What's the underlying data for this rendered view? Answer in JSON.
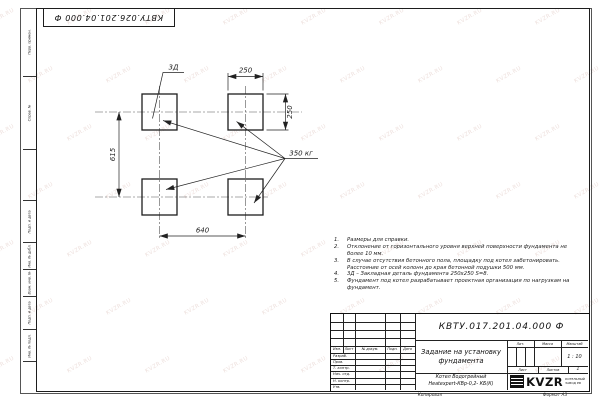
{
  "sheet": {
    "top_stamp": "КВТУ.026.201.04.000 Ф",
    "copied_label": "Копировал",
    "format_label": "Формат А3"
  },
  "watermark": {
    "text": "KVZR.RU"
  },
  "margin_boxes": [
    {
      "label": "Перв. примен."
    },
    {
      "label": "Справ. №"
    },
    {
      "label": "Подп. и дата"
    },
    {
      "label": "Инв. № дубл."
    },
    {
      "label": "Взам. инв. №"
    },
    {
      "label": "Подп. и дата"
    },
    {
      "label": "Инв. № подл."
    }
  ],
  "drawing": {
    "dim_top": "250",
    "dim_right": "250",
    "dim_left": "615",
    "dim_bottom": "640",
    "embed_label": "3Д",
    "weight_label": "350 кг"
  },
  "notes": [
    {
      "num": "1.",
      "text": "Размеры для справки."
    },
    {
      "num": "2.",
      "text": "Отклонение от горизонтального уровня верхней поверхности фундамента не более 10 мм."
    },
    {
      "num": "3.",
      "text": "В случае отсутствия бетонного пола, площадку под котел забетонировать. Расстояние от осей колонн до края бетонной подушки 500 мм."
    },
    {
      "num": "4.",
      "text": "3Д – Закладная деталь фундамента 250х250 S=8."
    },
    {
      "num": "5.",
      "text": "Фундамент под котел разрабатывает проектная организация по нагрузкам на фундамент."
    }
  ],
  "title_block": {
    "doc_number": "КВТУ.017.201.04.000 Ф",
    "title": "Задание на установку фундамента",
    "product_line1": "Котел Водогрейный",
    "product_line2": "Heatexpert-КВр-0,2- КБ(К)",
    "col_izm": "Изм.",
    "col_list": "Лист",
    "col_docnum": "№ докум.",
    "col_podp": "Подп.",
    "col_data": "Дата",
    "row_razrab": "Разраб.",
    "row_prov": "Пров.",
    "row_tkontr": "Т. контр.",
    "row_nachotd": "Нач. отд.",
    "row_nkontr": "Н. контр.",
    "row_utv": "Утв.",
    "lit_label": "Лит.",
    "mass_label": "Масса",
    "scale_label": "Масштаб",
    "scale_value": "1 : 10",
    "sheet_label": "Лист",
    "sheets_label": "Листов",
    "sheets_value": "1",
    "logo_text": "KVZR",
    "logo_caption_line1": "КОТЕЛЬНЫЙ",
    "logo_caption_line2": "ЗАВОД РФ"
  }
}
